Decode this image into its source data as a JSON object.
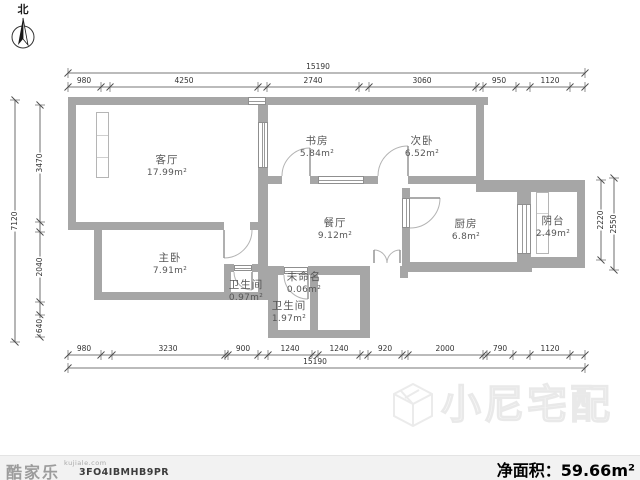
{
  "north_label": "北",
  "rooms": [
    {
      "name": "客厅",
      "area": "17.99m²"
    },
    {
      "name": "书房",
      "area": "5.84m²"
    },
    {
      "name": "次卧",
      "area": "6.52m²"
    },
    {
      "name": "餐厅",
      "area": "9.12m²"
    },
    {
      "name": "厨房",
      "area": "6.8m²"
    },
    {
      "name": "阴台",
      "area": "2.49m²"
    },
    {
      "name": "主卧",
      "area": "7.91m²"
    },
    {
      "name": "卫生间",
      "area": "0.97m²"
    },
    {
      "name": "未命名",
      "area": "0.06m²"
    },
    {
      "name": "卫生间",
      "area": "1.97m²"
    }
  ],
  "dimensions": {
    "top_total": "15190",
    "top_segments": [
      "980",
      "4250",
      "2740",
      "3060",
      "950",
      "1120"
    ],
    "bottom_total": "15190",
    "bottom_segments": [
      "980",
      "3230",
      "900",
      "1240",
      "1240",
      "920",
      "2000",
      "790",
      "1120"
    ],
    "left_total": "7120",
    "left_segments": [
      "3470",
      "2040",
      "640"
    ],
    "right_inner": "2220",
    "right_outer": "2550"
  },
  "footer": {
    "brand": "酷家乐",
    "brand_site": "kujiale.com",
    "plan_id": "3FO4IBMHB9PR",
    "net_area_label": "净面积：",
    "net_area_value": "59.66m²"
  },
  "watermark": {
    "text": "小尼宅配"
  },
  "colors": {
    "wall": "#a6a6a6",
    "dim_line": "#4a4a4a",
    "footer_bg": "#f2f2f2"
  }
}
